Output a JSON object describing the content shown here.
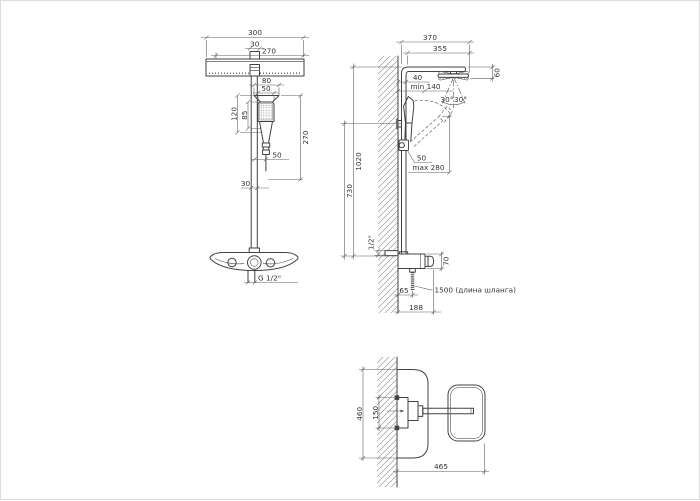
{
  "drawing": {
    "product": "Shower column dimensional drawing",
    "units": "mm"
  },
  "front_view": {
    "head_width": "300",
    "arm_tube": "30",
    "head_face": "270",
    "bracket_width": "80",
    "handset_width": "50",
    "handset_head_len": "120",
    "handset_face_len": "85",
    "handset_length": "270",
    "hose_offset": "50",
    "riser_tube": "30",
    "outlet_thread": "G 1/2\""
  },
  "side_view": {
    "reach_overall": "370",
    "reach": "355",
    "wall_offset": "40",
    "min_clearance": "min 140",
    "head_depth": "60",
    "tilt_left": "30°",
    "tilt_right": "30°",
    "height_total": "1020",
    "height_lower": "730",
    "bracket_offset": "50",
    "bracket_travel": "max 280",
    "inlet_thread": "1/2\"",
    "body_height": "70",
    "hose_wall_offset": "65",
    "body_depth": "188",
    "hose_note": "1500 (длина шланга)"
  },
  "top_view": {
    "tray_width": "460",
    "plate_width": "150",
    "depth_overall": "465"
  }
}
